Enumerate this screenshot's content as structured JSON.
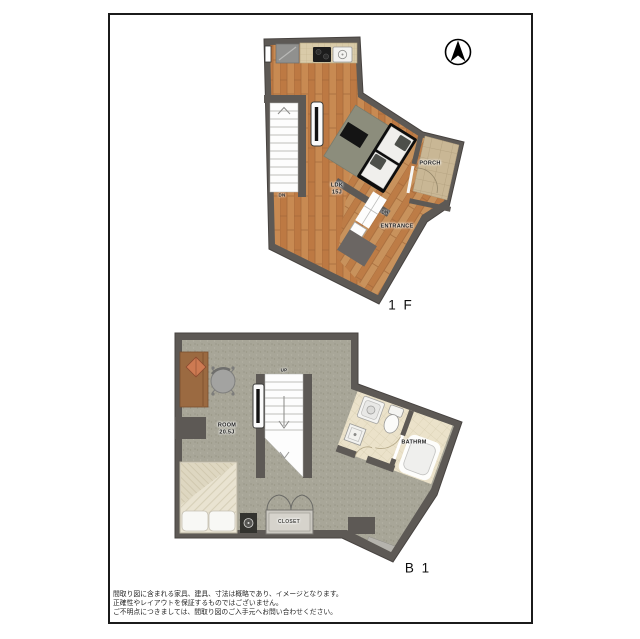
{
  "document": {
    "type": "real-estate-floorplan",
    "compass": {
      "icon": "north-arrow-compass-icon",
      "direction": "N"
    }
  },
  "floor1": {
    "label": "1 F",
    "ldk": {
      "name": "LDK",
      "size": "15J"
    },
    "porch": "PORCH",
    "entrance": "ENTRANCE",
    "stairs_dn": "DN",
    "entrance_dn": "DN"
  },
  "floorB1": {
    "label": "B 1",
    "room": {
      "name": "ROOM",
      "size": "20.5J"
    },
    "bathroom": "BATHRM",
    "closet": "CLOSET",
    "stairs_up": "UP"
  },
  "disclaimer": {
    "line1": "間取り図に含まれる家具、建具、寸法は概略であり、イメージとなります。",
    "line2": "正確性やレイアウトを保証するものではございません。",
    "line3": "ご不明点につきましては、間取り図のご入手元へお問い合わせください。"
  },
  "colors": {
    "wall": "#5d5955",
    "wood_floor": "#c88a52",
    "carpet": "#a8a698",
    "porch_tile": "#c9b795",
    "bath_tile": "#ebe2ca",
    "rug": "#8c8d7c",
    "border": "#1b1b1b"
  }
}
